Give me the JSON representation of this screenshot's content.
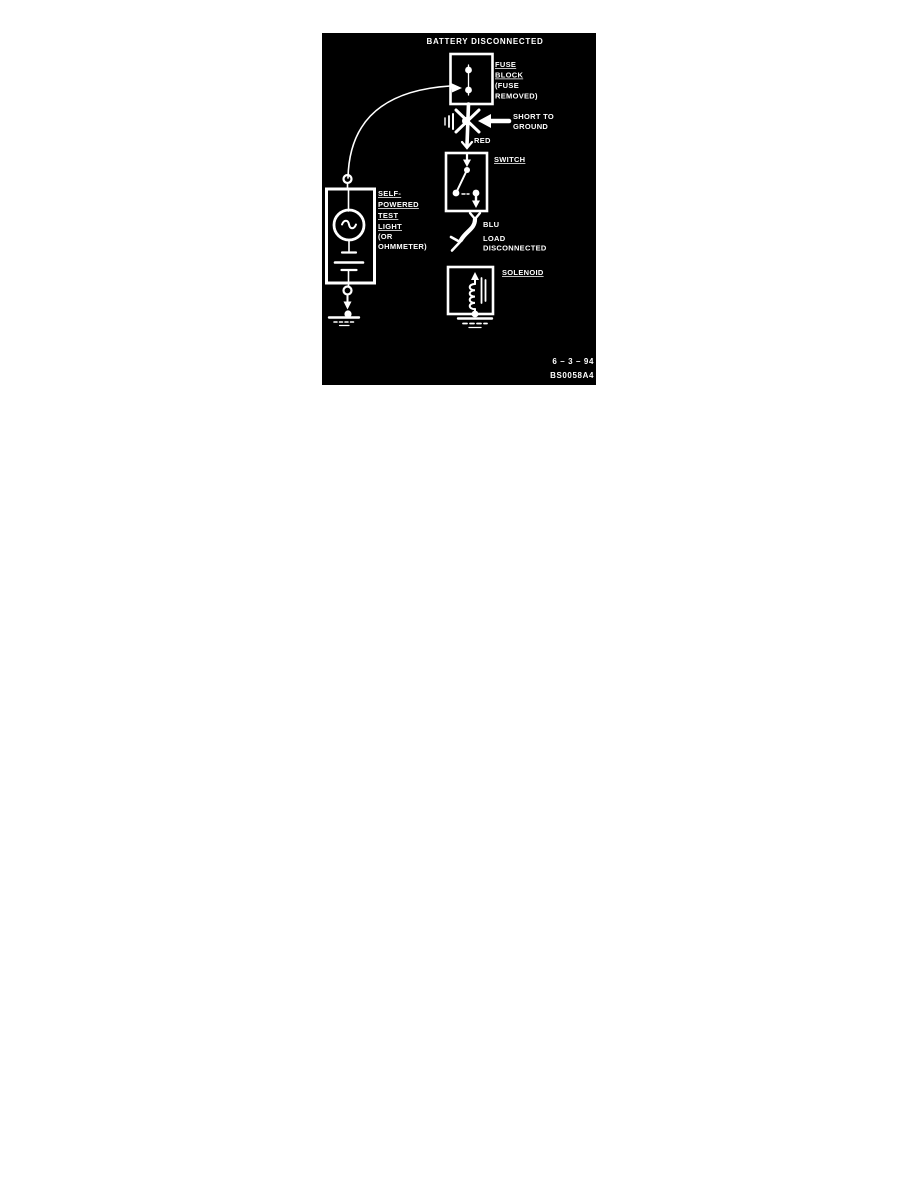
{
  "panel": {
    "title": "BATTERY DISCONNECTED",
    "fuse_block": {
      "label": [
        "FUSE",
        "BLOCK",
        "(FUSE",
        "REMOVED)"
      ]
    },
    "short_to_ground": {
      "label": [
        "SHORT TO",
        "GROUND"
      ]
    },
    "wires": {
      "red": "RED",
      "blu": "BLU"
    },
    "switch": {
      "label": "SWITCH"
    },
    "load": {
      "label": [
        "LOAD",
        "DISCONNECTED"
      ]
    },
    "solenoid": {
      "label": "SOLENOID"
    },
    "test_light": {
      "label": [
        "SELF-",
        "POWERED",
        "TEST",
        "LIGHT",
        "(OR",
        "OHMMETER)"
      ]
    },
    "footer": {
      "date": "6 – 3 – 94",
      "figure_id": "BS0058A4"
    },
    "colors": {
      "page_bg": "#ffffff",
      "panel_bg": "#000000",
      "ink": "#ffffff"
    }
  }
}
